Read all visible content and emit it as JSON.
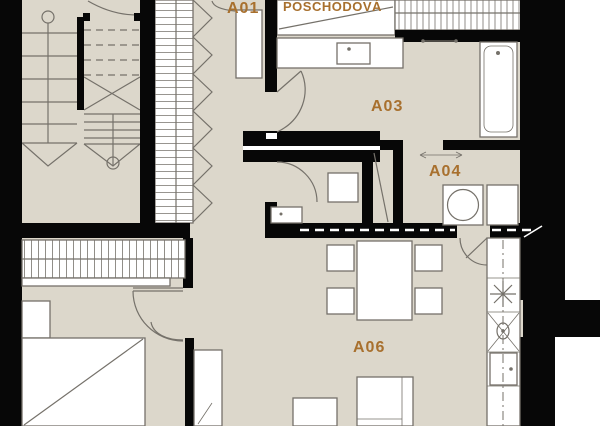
{
  "colors": {
    "floor": "#DCD7CB",
    "wall": "#070707",
    "label": "#A8702E",
    "line": "#75716A",
    "furniture_fill": "#FFFFFF",
    "exterior": "#FFFFFF"
  },
  "rooms": [
    {
      "id": "A01",
      "label": "A01"
    },
    {
      "id": "A03",
      "label": "A03"
    },
    {
      "id": "A04",
      "label": "A04"
    },
    {
      "id": "A06",
      "label": "A06"
    }
  ],
  "annotations": {
    "landing_label": "POSCHODOVÁ"
  },
  "fixtures": [
    "staircase-icon",
    "wardrobe-rail-icon",
    "folding-door-icon",
    "swing-door-icon",
    "sliding-pocket-door-icon",
    "washbasin-icon",
    "towel-rail-icon",
    "bathtub-icon",
    "toilet-icon",
    "washing-machine-icon",
    "dryer-icon",
    "dining-table-icon",
    "chair-icon",
    "cooktop-icon",
    "kitchen-sink-icon",
    "kitchen-cabinet-icon",
    "bed-icon",
    "nightstand-icon",
    "sofa-icon",
    "tall-cabinet-icon"
  ]
}
